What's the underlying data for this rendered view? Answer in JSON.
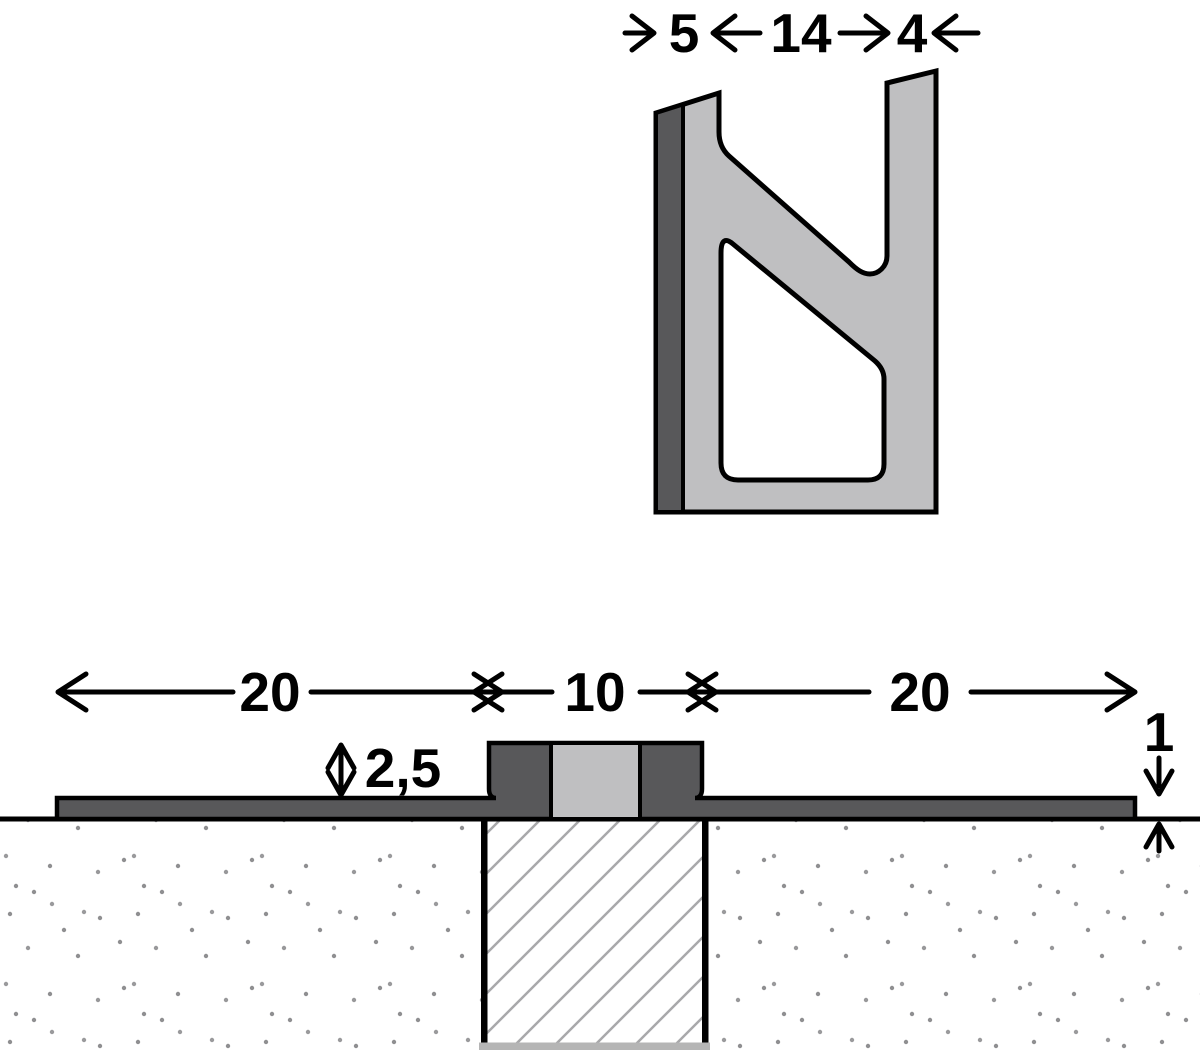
{
  "diagram": {
    "kind": "expansion-joint-technical-drawing",
    "profile_view": {
      "dim_left": "5",
      "dim_middle": "14",
      "dim_right": "4"
    },
    "section_view": {
      "dim_left_flange": "20",
      "dim_center": "10",
      "dim_right_flange": "20",
      "dim_upstand": "2,5",
      "dim_edge": "1"
    },
    "colors": {
      "dark_gray": "#58585a",
      "light_gray": "#bfbfc1",
      "outline": "#000000",
      "hatch_line": "#a8a8aa",
      "stipple_dot": "#8f8f91",
      "filler_bottom": "#b5b5b5",
      "background": "#ffffff"
    }
  }
}
